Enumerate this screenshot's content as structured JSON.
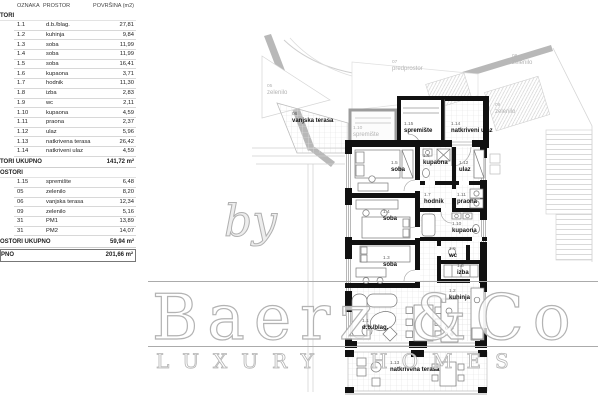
{
  "table": {
    "headers": [
      "OZNAKA",
      "PROSTOR",
      "POVRŠINA (m2)"
    ],
    "section1": {
      "header": "TORI",
      "rows": [
        {
          "code": "1.1",
          "name": "d.b./blag.",
          "area": "27,81"
        },
        {
          "code": "1.2",
          "name": "kuhinja",
          "area": "9,84"
        },
        {
          "code": "1.3",
          "name": "soba",
          "area": "11,99"
        },
        {
          "code": "1.4",
          "name": "soba",
          "area": "11,99"
        },
        {
          "code": "1.5",
          "name": "soba",
          "area": "16,41"
        },
        {
          "code": "1.6",
          "name": "kupaona",
          "area": "3,71"
        },
        {
          "code": "1.7",
          "name": "hodnik",
          "area": "11,30"
        },
        {
          "code": "1.8",
          "name": "izba",
          "area": "2,83"
        },
        {
          "code": "1.9",
          "name": "wc",
          "area": "2,11"
        },
        {
          "code": "1.10",
          "name": "kupaona",
          "area": "4,59"
        },
        {
          "code": "1.11",
          "name": "praona",
          "area": "2,37"
        },
        {
          "code": "1.12",
          "name": "ulaz",
          "area": "5,96"
        },
        {
          "code": "1.13",
          "name": "natkrivena terasa",
          "area": "26,42"
        },
        {
          "code": "1.14",
          "name": "natkriveni ulaz",
          "area": "4,59"
        }
      ],
      "total_label": "TORI UKUPNO",
      "total_value": "141,72 m²"
    },
    "section2": {
      "header": "OSTORI",
      "rows": [
        {
          "code": "1.15",
          "name": "spremište",
          "area": "6,48"
        },
        {
          "code": "05",
          "name": "zelenilo",
          "area": "8,20"
        },
        {
          "code": "06",
          "name": "vanjska terasa",
          "area": "12,34"
        },
        {
          "code": "09",
          "name": "zelenilo",
          "area": "5,16"
        },
        {
          "code": "31",
          "name": "PM1",
          "area": "13,89"
        },
        {
          "code": "31",
          "name": "PM2",
          "area": "14,07"
        }
      ],
      "total_label": "OSTORI UKUPNO",
      "total_value": "59,94 m²"
    },
    "grand_total": {
      "label": "PNO",
      "value": "201,66 m²"
    }
  },
  "plan": {
    "labels": [
      {
        "code": "05",
        "name": "zelenilo"
      },
      {
        "code": "06",
        "name": "vanjska terasa"
      },
      {
        "code": "07",
        "name": "predprostor"
      },
      {
        "code": "08",
        "name": "zelenilo"
      },
      {
        "code": "09",
        "name": "zelenilo"
      },
      {
        "code": "1.10",
        "name": "spremište"
      },
      {
        "code": "1.15",
        "name": "spremište"
      },
      {
        "code": "1.14",
        "name": "natkriveni ulaz"
      },
      {
        "code": "1.5",
        "name": "soba"
      },
      {
        "code": "1.6",
        "name": "kupaona"
      },
      {
        "code": "1.12",
        "name": "ulaz"
      },
      {
        "code": "1.7",
        "name": "hodnik"
      },
      {
        "code": "1.11",
        "name": "praona"
      },
      {
        "code": "1.4",
        "name": "soba"
      },
      {
        "code": "1.10",
        "name": "kupaona"
      },
      {
        "code": "1.3",
        "name": "soba"
      },
      {
        "code": "1.9",
        "name": "wc"
      },
      {
        "code": "1.8",
        "name": "izba"
      },
      {
        "code": "1.2",
        "name": "kuhinja"
      },
      {
        "code": "1.1",
        "name": "d.b./blag."
      },
      {
        "code": "1.13",
        "name": "natkrivena terasa"
      }
    ]
  },
  "watermark": {
    "by": "by",
    "brand": "Baerz &Co",
    "tagline": "LUXURY HOMES"
  },
  "colors": {
    "wall": "#111111",
    "site_gray": "#b8b8b8",
    "label_gray": "#b3b3b3",
    "watermark_gray": "#b3b3b3"
  }
}
